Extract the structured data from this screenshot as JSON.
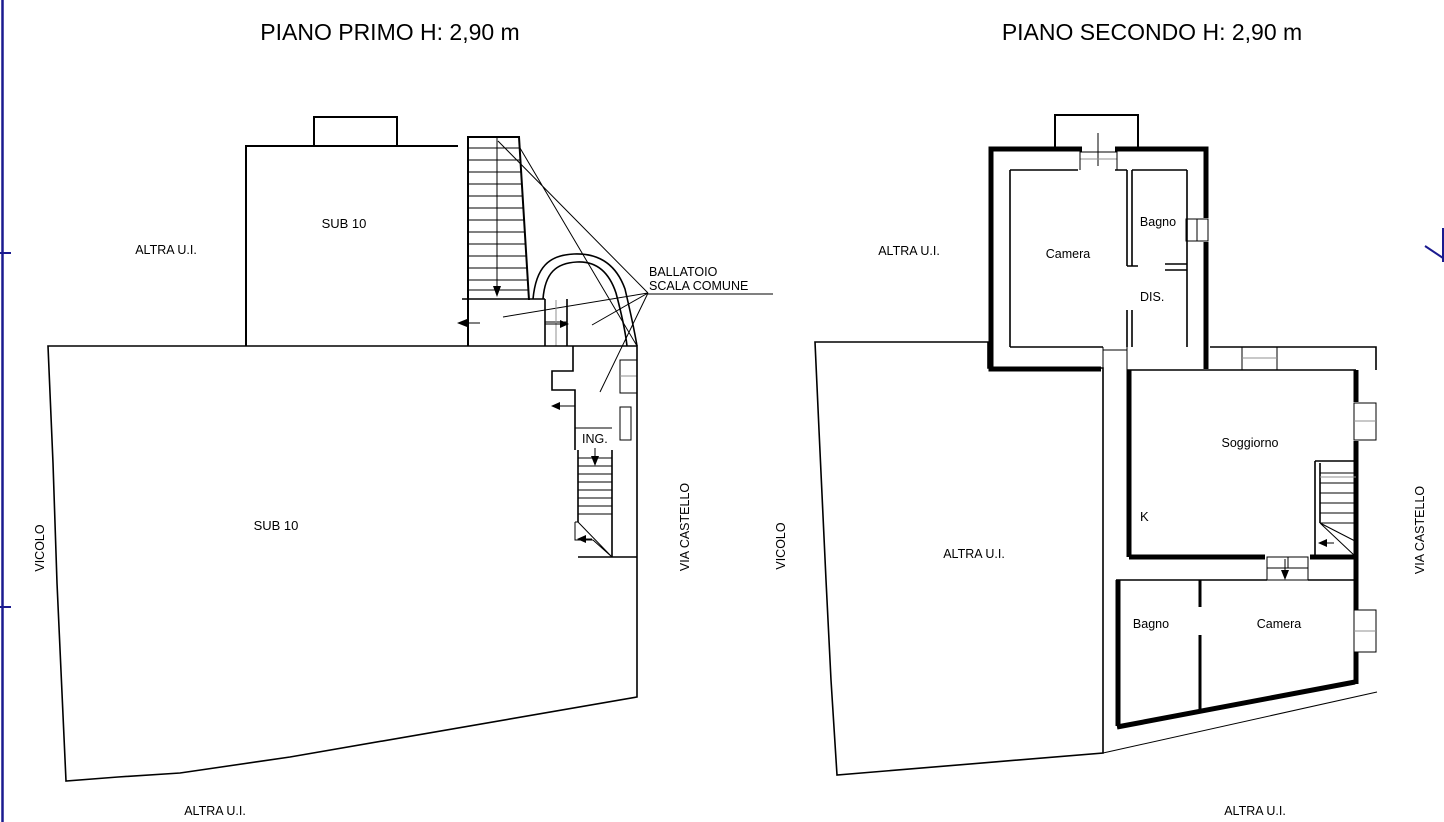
{
  "page": {
    "background": "#ffffff",
    "line_color": "#000000",
    "gray_line_color": "#909090",
    "sheet_border_color": "#1a1a8f"
  },
  "left_plan": {
    "title": "PIANO PRIMO H: 2,90 m",
    "rooms": {
      "sub10_upper": "SUB 10",
      "sub10_lower": "SUB 10",
      "ingresso": "ING."
    },
    "annotations": {
      "ballatoio_line1": "BALLATOIO",
      "ballatoio_line2": "SCALA COMUNE",
      "altra_ui_side": "ALTRA U.I.",
      "altra_ui_bottom": "ALTRA U.I."
    },
    "streets": {
      "left": "VICOLO",
      "right": "VIA CASTELLO"
    }
  },
  "right_plan": {
    "title": "PIANO SECONDO H: 2,90 m",
    "rooms": {
      "camera_top": "Camera",
      "bagno_top": "Bagno",
      "disimpegno": "DIS.",
      "soggiorno": "Soggiorno",
      "kitchen": "K",
      "bagno_bottom": "Bagno",
      "camera_bottom": "Camera"
    },
    "annotations": {
      "altra_ui_side": "ALTRA U.I.",
      "altra_ui_main": "ALTRA U.I.",
      "altra_ui_bottom": "ALTRA U.I."
    },
    "streets": {
      "left": "VICOLO",
      "right": "VIA CASTELLO"
    }
  }
}
